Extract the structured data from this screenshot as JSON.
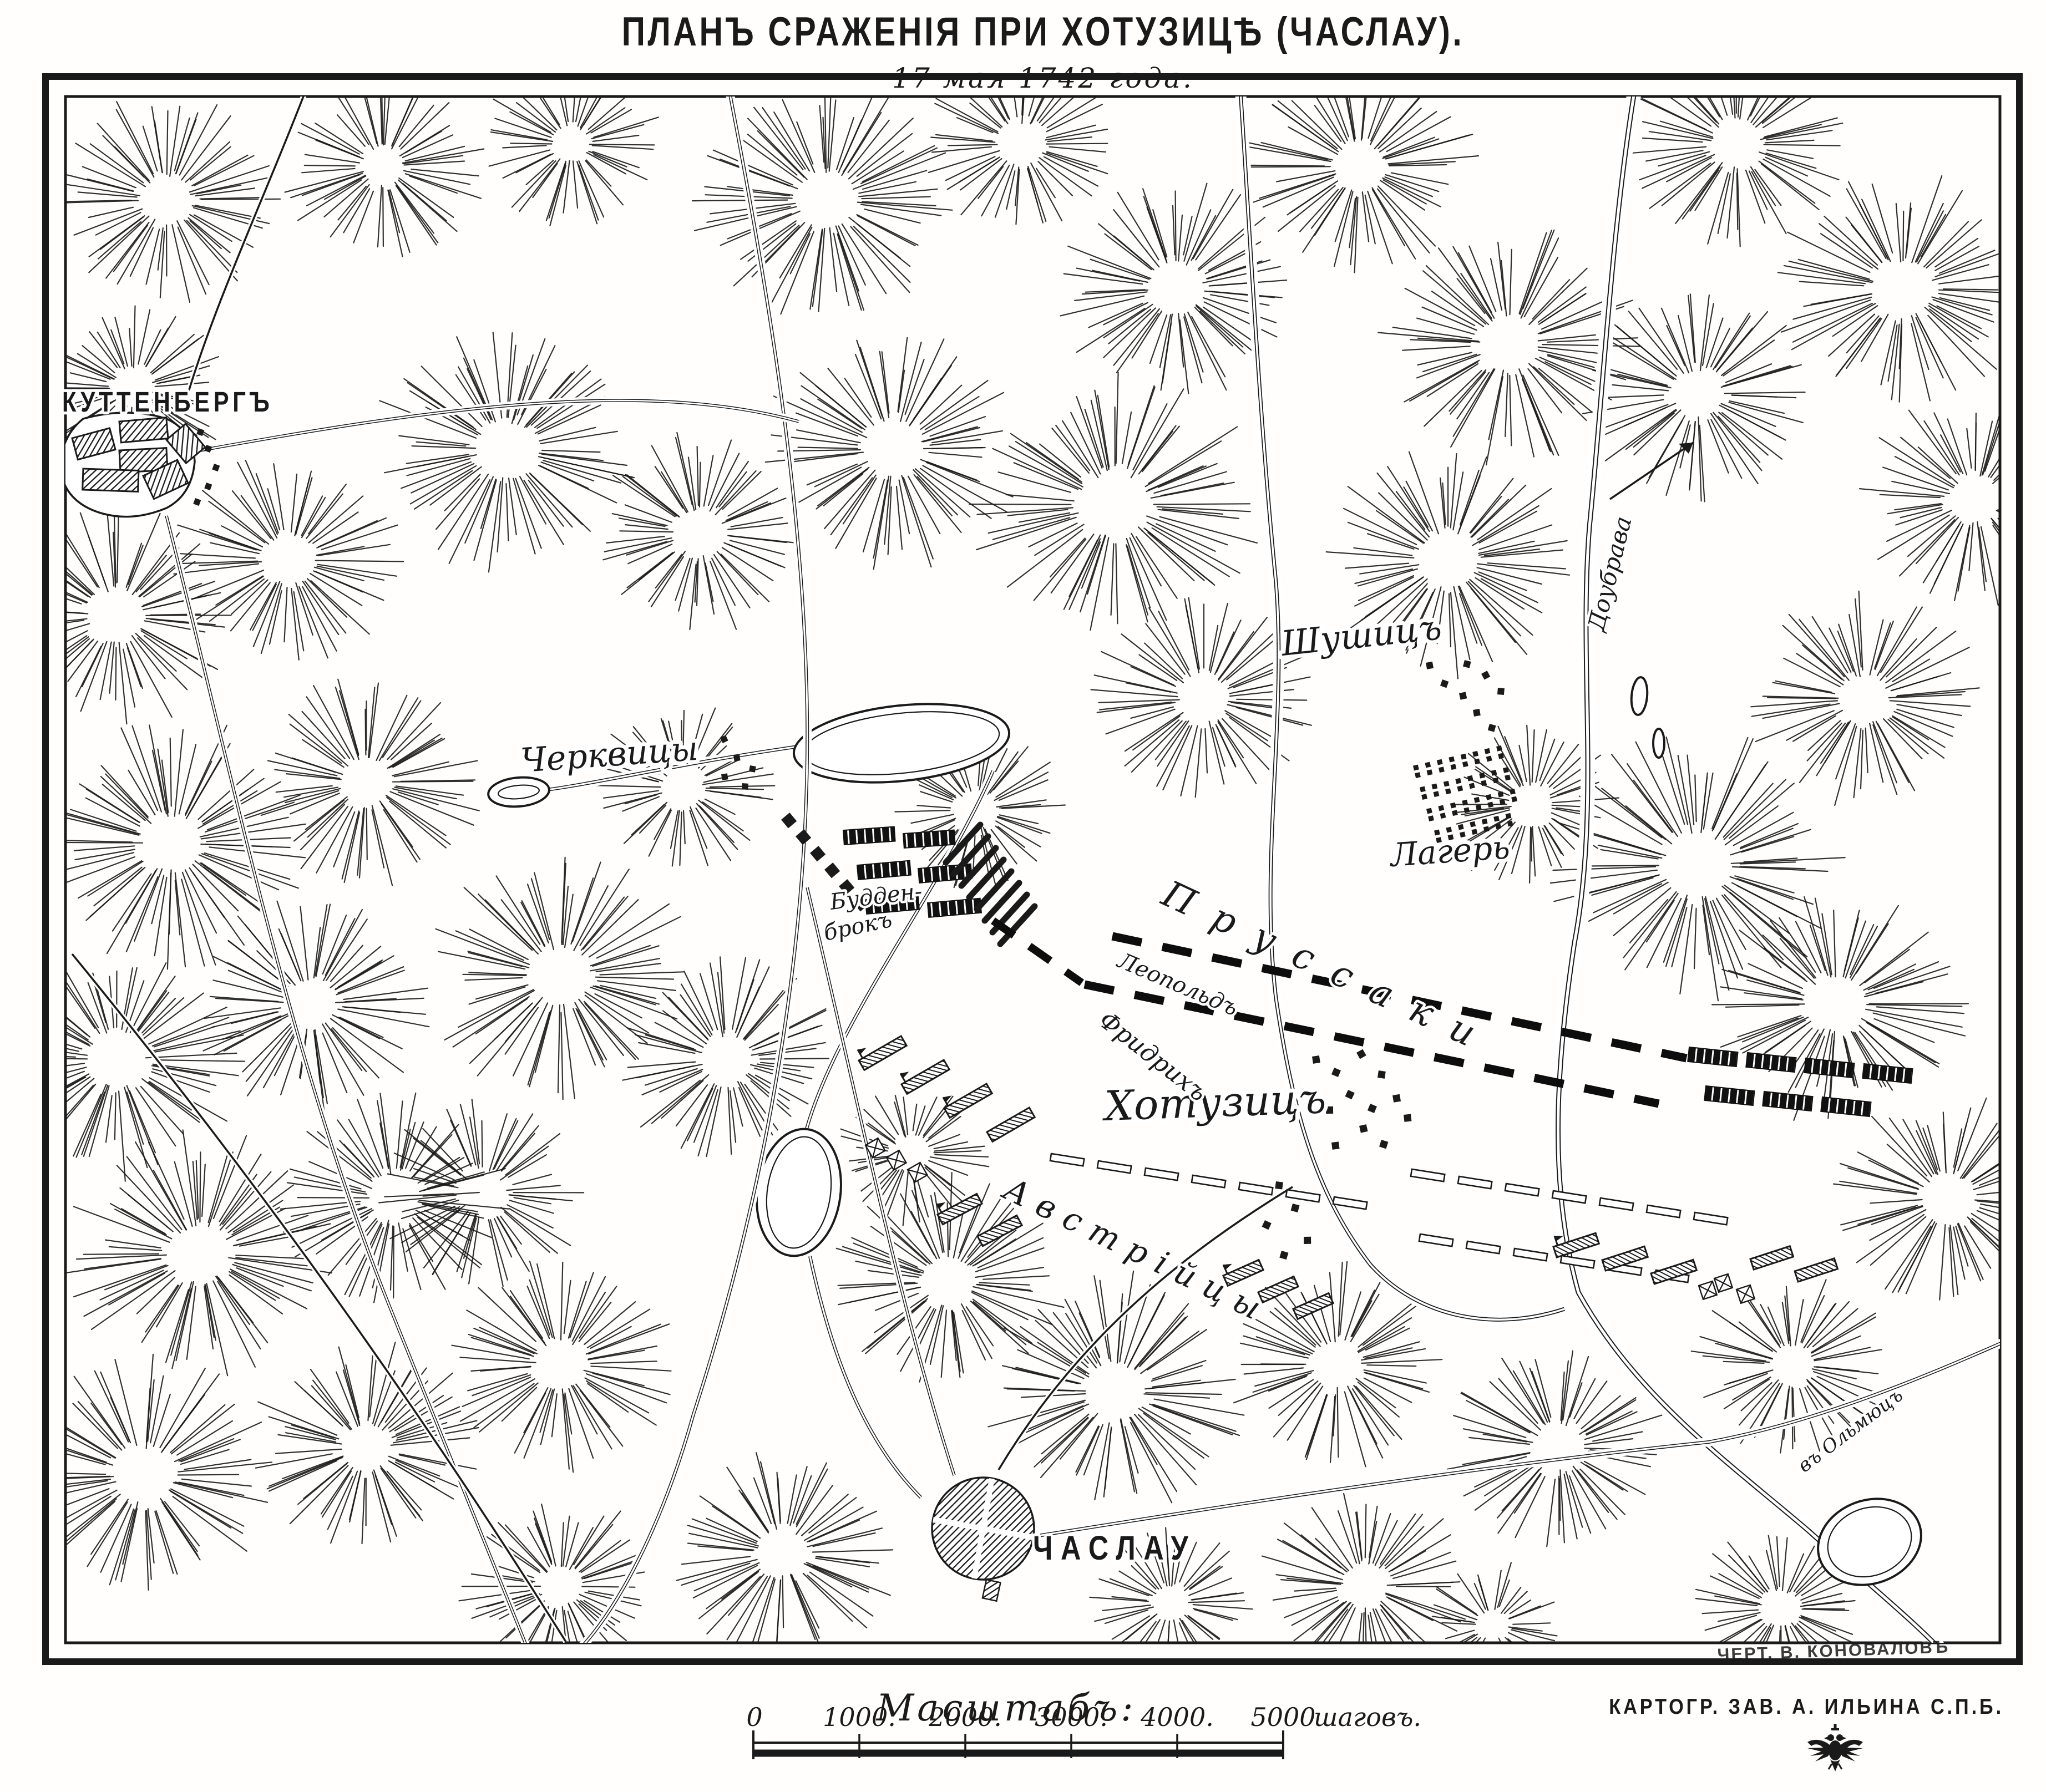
{
  "header": {
    "title": "ПЛАНЪ СРАЖЕНІЯ ПРИ ХОТУЗИЦѢ (ЧАСЛАУ).",
    "subtitle": "17 мая 1742 года."
  },
  "map": {
    "towns": {
      "kuttenberg": "КУТТЕНБЕРГЪ",
      "czaslau": "ЧАСЛАУ"
    },
    "villages": {
      "cherkvitsy": "Черквицы",
      "shushitz": "Шушицъ",
      "khotuzitz": "Хотузицъ"
    },
    "forces": {
      "prussians": "Пруссаки",
      "leopold": "Леопольдъ",
      "friedrich": "Фридрихъ",
      "buddenbrock_line1": "Будден-",
      "buddenbrock_line2": "брокъ",
      "austrians": "Австрійцы",
      "camp": "Лагерь"
    },
    "waterways": {
      "doubrava": "Доубрава"
    },
    "routes": {
      "olmutz": "въ Ольмюцъ"
    }
  },
  "scale": {
    "heading": "Масштабъ:",
    "ticks": [
      "0",
      "1000.",
      "2000.",
      "3000.",
      "4000.",
      "5000"
    ],
    "unit": "шаговъ."
  },
  "credits": {
    "publisher": "КАРТОГР. ЗАВ. А. ИЛЬИНА С.П.Б.",
    "engraver_signature": "ЧЕРТ. В. КОНОВАЛОВЪ",
    "emblem_icon": "double-headed-eagle"
  },
  "colors": {
    "ink": "#1a1a1a",
    "paper": "#fffefd"
  }
}
